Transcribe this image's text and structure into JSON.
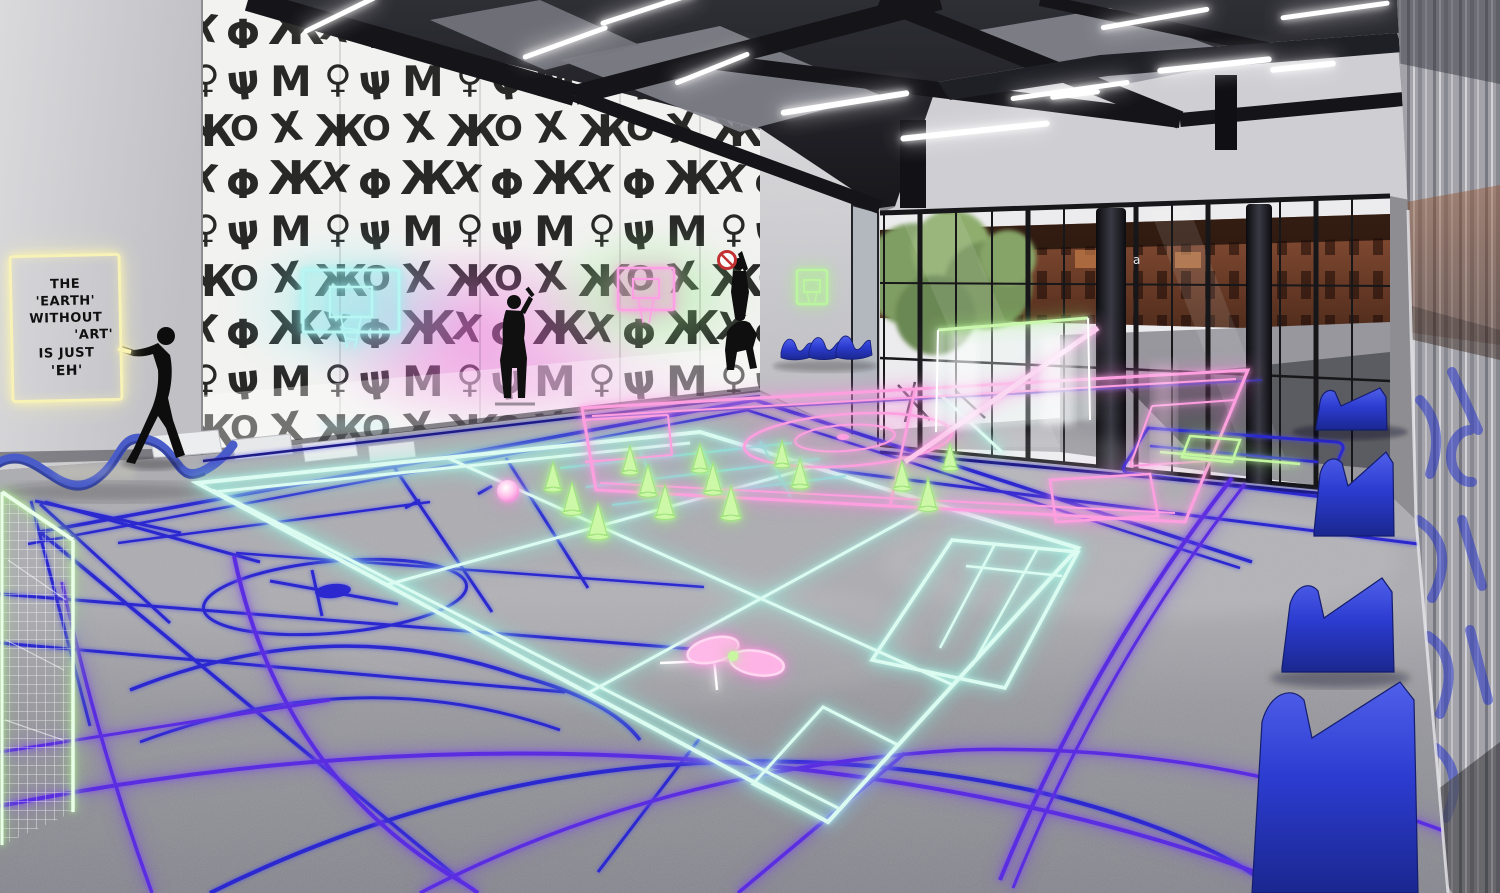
{
  "artwork_sign": {
    "lines": [
      "THE",
      "'EARTH'",
      "WITHOUT",
      "'ART'",
      "IS JUST",
      "'EH'"
    ],
    "frame_color": "#f8f2b6",
    "text_color": "#101010"
  },
  "window_decal": {
    "text": "a"
  },
  "palette": {
    "floor_far": "#a9a9ae",
    "floor_near": "#82828a",
    "ceiling": "#232329",
    "wall_light": "#d6d6d9",
    "graffiti_ink": "#161616",
    "neon_mint": "#dcfcf2",
    "neon_blue": "#2b28cf",
    "neon_violet": "#5a2de0",
    "neon_pink": "#ff9fe0",
    "neon_green": "#c5f7a2",
    "neon_cyan": "#8fe5de",
    "neon_yellow": "#f8f2b6",
    "seat_blue": "#2b3fd4",
    "exterior_brown": "#7c4630"
  },
  "objects": {
    "list": [
      "neon-quote-sign",
      "painter-stencil-figure",
      "standing-stencil-figure",
      "acrobat-stencil-figures",
      "cyan-neon-basketball-hoop",
      "pink-neon-basketball-hoop",
      "green-neon-basketball-hoop",
      "glowing-goal-net",
      "glowing-training-cones",
      "glowing-pink-ball",
      "glowing-rackets",
      "glowing-net",
      "blue-wave-chairs",
      "blue-bleacher-seats",
      "blue-ribbon-sculpture",
      "calligraphy-graffiti-wall",
      "glass-window-wall",
      "reflective-blue-graffiti-wall",
      "neon-court-lines",
      "ceiling-truss-lights"
    ]
  }
}
